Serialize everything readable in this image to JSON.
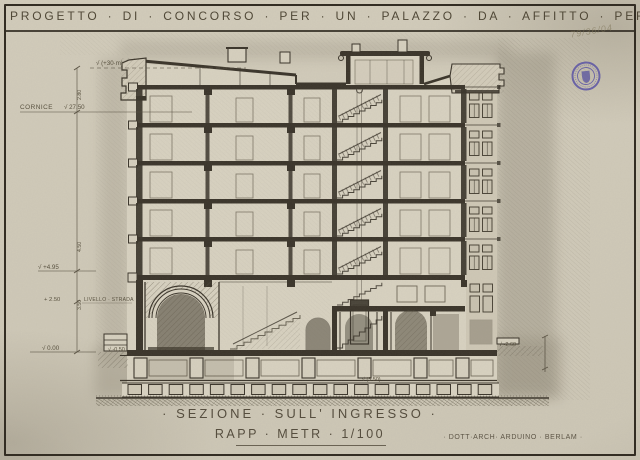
{
  "header": {
    "title": "PROGETTO · DI · CONCORSO · PER · UN · PALAZZO · DA · AFFITTO · PER · LA · R·A·S"
  },
  "notes": {
    "pencil": "79/36/04"
  },
  "stamp": {
    "name": "round-archive-stamp",
    "color": "#4f4aa0"
  },
  "levels": {
    "top": "√ (+30·m)",
    "cornice_label": "CORNICE",
    "cornice_value": "√ 27.50",
    "first_floor": "√ +4.95",
    "street_value": "+ 2.50",
    "street_label": "LIVELLO · STRADA",
    "zero": "√ 0.00",
    "minus_half": "√ -0.50",
    "cellar": "√ (3.50)",
    "right_ground": "√ -2.60",
    "dims": {
      "d1": "2.80",
      "d2": "4.50",
      "d3": "3.50"
    }
  },
  "footer": {
    "section_title": "· SEZIONE · SULL' INGRESSO ·",
    "scale": "RAPP · METR · 1/100",
    "credit": "· DOTT·ARCH· ARDUINO · BERLAM ·"
  },
  "colors": {
    "paper": "#d6d0bf",
    "ink": "#3a342a",
    "pencil": "#8a8374",
    "stamp": "#4f4aa0"
  }
}
